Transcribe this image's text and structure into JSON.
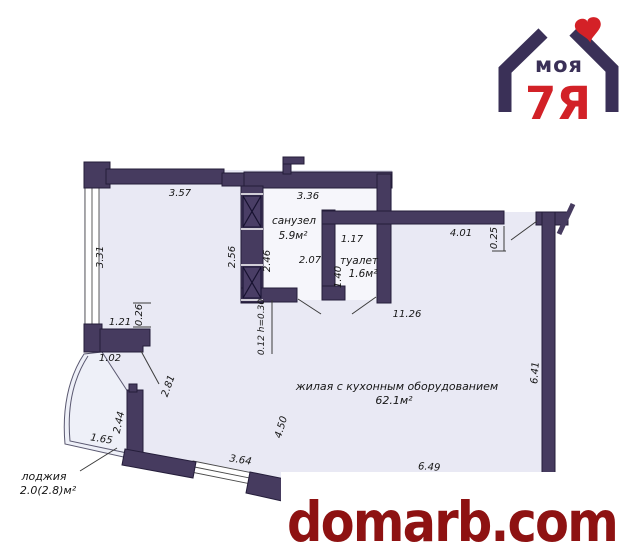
{
  "logo": {
    "word": "моя",
    "brand": "7Я",
    "navy": "#3a3057",
    "red": "#d42127"
  },
  "watermark": {
    "text": "domarb.com",
    "color": "#8e1212"
  },
  "rooms": {
    "bathroom": {
      "name": "санузел",
      "area": "5.9м²"
    },
    "toilet": {
      "name": "туалет",
      "area": "1.6м²"
    },
    "living": {
      "name": "жилая с кухонным оборудованием",
      "area": "62.1м²"
    },
    "loggia": {
      "name": "лоджия",
      "area": "2.0(2.8)м²"
    }
  },
  "dims": {
    "top_left_wall": "3.57",
    "left_wall": "3.31",
    "bathroom_top": "3.36",
    "shaft_outer": "2.56",
    "shaft_inner": "2.46",
    "bathroom_width": "2.07",
    "toilet_width": "1.17",
    "toilet_depth": "1.40",
    "hall_top": "4.01",
    "entry_offset": "0.25",
    "living_width": "11.26",
    "niche_depth": "0.26",
    "niche_width": "1.21",
    "pier": "1.02",
    "balcony_door": "2.81",
    "sill": "0.12 h=0.30",
    "loggia_depth": "2.44",
    "loggia_width": "1.65",
    "window_width": "3.64",
    "bay_depth": "4.50",
    "bottom_wall": "6.49",
    "right_wall": "6.41"
  },
  "colors": {
    "wall": "#463b5f",
    "floor": "#e9e9f4",
    "bathroom_floor": "#f6f6fb",
    "watermark": "#8e1212"
  }
}
